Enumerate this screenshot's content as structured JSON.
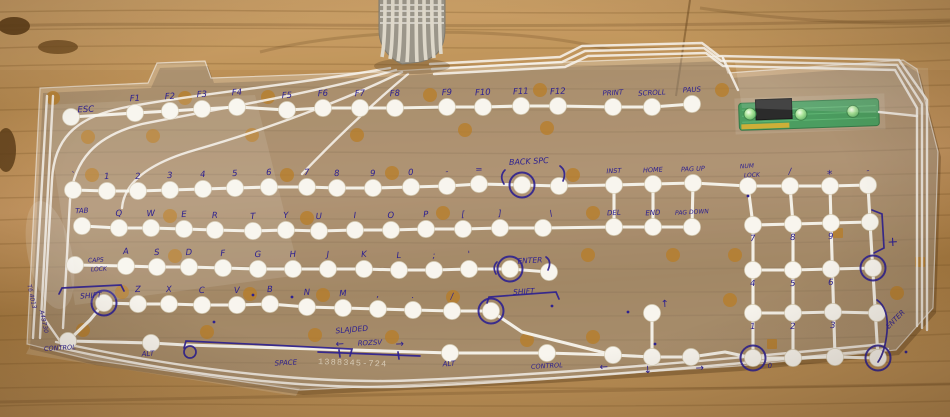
{
  "colors": {
    "wood": "#b88c52",
    "ink": "#2e2190",
    "trace": "#f8f5ee",
    "adhesive_dot": "#b97c22",
    "pcb_green": "#37924e",
    "led_green": "#6fd06f",
    "ribbon_gray": "#9b968a"
  },
  "pcb": {
    "led_count": 3
  },
  "membrane": {
    "part_number": "1388345-724",
    "keys": [
      {
        "t": "ESC",
        "x": 71,
        "y": 117,
        "lx": 86,
        "ly": 112
      },
      {
        "t": "F1",
        "x": 135,
        "y": 113
      },
      {
        "t": "F2",
        "x": 170,
        "y": 111
      },
      {
        "t": "F3",
        "x": 202,
        "y": 109
      },
      {
        "t": "F4",
        "x": 237,
        "y": 107
      },
      {
        "t": "F5",
        "x": 287,
        "y": 110
      },
      {
        "t": "F6",
        "x": 323,
        "y": 108
      },
      {
        "t": "F7",
        "x": 360,
        "y": 108
      },
      {
        "t": "F8",
        "x": 395,
        "y": 108
      },
      {
        "t": "F9",
        "x": 447,
        "y": 107
      },
      {
        "t": "F10",
        "x": 483,
        "y": 107
      },
      {
        "t": "F11",
        "x": 521,
        "y": 106
      },
      {
        "t": "F12",
        "x": 558,
        "y": 106
      },
      {
        "t": "PRINT",
        "x": 613,
        "y": 107,
        "s": 7
      },
      {
        "t": "SCROLL",
        "x": 652,
        "y": 107,
        "s": 7
      },
      {
        "t": "PAUS",
        "x": 692,
        "y": 104,
        "s": 7
      },
      {
        "t": "`",
        "x": 73,
        "y": 190
      },
      {
        "t": "1",
        "x": 107,
        "y": 191
      },
      {
        "t": "2",
        "x": 138,
        "y": 191
      },
      {
        "t": "3",
        "x": 170,
        "y": 190
      },
      {
        "t": "4",
        "x": 203,
        "y": 189
      },
      {
        "t": "5",
        "x": 235,
        "y": 188
      },
      {
        "t": "6",
        "x": 269,
        "y": 187
      },
      {
        "t": "7",
        "x": 307,
        "y": 187
      },
      {
        "t": "8",
        "x": 337,
        "y": 188
      },
      {
        "t": "9",
        "x": 373,
        "y": 188
      },
      {
        "t": "0",
        "x": 411,
        "y": 187
      },
      {
        "t": "-",
        "x": 447,
        "y": 186
      },
      {
        "t": "=",
        "x": 479,
        "y": 184
      },
      {
        "t": "",
        "x": 522,
        "y": 185,
        "r": 1
      },
      {
        "t": "",
        "x": 559,
        "y": 186
      },
      {
        "t": "INST",
        "x": 614,
        "y": 185,
        "s": 6.5
      },
      {
        "t": "HOME",
        "x": 653,
        "y": 184,
        "s": 6.5
      },
      {
        "t": "PAG UP",
        "x": 693,
        "y": 183,
        "s": 6.5
      },
      {
        "t": "",
        "x": 748,
        "y": 186
      },
      {
        "t": "/",
        "x": 790,
        "y": 186
      },
      {
        "t": "*",
        "x": 830,
        "y": 186,
        "s": 11,
        "ly": 178
      },
      {
        "t": "-",
        "x": 868,
        "y": 185
      },
      {
        "t": "TAB",
        "x": 82,
        "y": 226,
        "s": 7,
        "ly": 213
      },
      {
        "t": "Q",
        "x": 119,
        "y": 228
      },
      {
        "t": "W",
        "x": 151,
        "y": 228
      },
      {
        "t": "E",
        "x": 184,
        "y": 229
      },
      {
        "t": "R",
        "x": 215,
        "y": 230
      },
      {
        "t": "T",
        "x": 253,
        "y": 231
      },
      {
        "t": "Y",
        "x": 286,
        "y": 230
      },
      {
        "t": "U",
        "x": 319,
        "y": 231
      },
      {
        "t": "I",
        "x": 355,
        "y": 230
      },
      {
        "t": "O",
        "x": 391,
        "y": 230
      },
      {
        "t": "P",
        "x": 426,
        "y": 229
      },
      {
        "t": "[",
        "x": 463,
        "y": 229
      },
      {
        "t": "]",
        "x": 500,
        "y": 228
      },
      {
        "t": "\\",
        "x": 543,
        "y": 228,
        "lx": 551,
        "ly": 216
      },
      {
        "t": "DEL",
        "x": 614,
        "y": 227,
        "s": 7
      },
      {
        "t": "END",
        "x": 653,
        "y": 227,
        "s": 7
      },
      {
        "t": "PAG DOWN",
        "x": 692,
        "y": 227,
        "s": 6,
        "ly": 214
      },
      {
        "t": "7",
        "x": 753,
        "y": 225,
        "ly": 241
      },
      {
        "t": "8",
        "x": 793,
        "y": 224,
        "ly": 240
      },
      {
        "t": "9",
        "x": 831,
        "y": 223,
        "ly": 239
      },
      {
        "t": "",
        "x": 870,
        "y": 222
      },
      {
        "t": "",
        "x": 75,
        "y": 265
      },
      {
        "t": "A",
        "x": 126,
        "y": 266
      },
      {
        "t": "S",
        "x": 157,
        "y": 267
      },
      {
        "t": "D",
        "x": 189,
        "y": 267
      },
      {
        "t": "F",
        "x": 223,
        "y": 268
      },
      {
        "t": "G",
        "x": 258,
        "y": 269
      },
      {
        "t": "H",
        "x": 293,
        "y": 269
      },
      {
        "t": "J",
        "x": 328,
        "y": 269
      },
      {
        "t": "K",
        "x": 364,
        "y": 269
      },
      {
        "t": "L",
        "x": 399,
        "y": 270
      },
      {
        "t": ";",
        "x": 434,
        "y": 270
      },
      {
        "t": "'",
        "x": 469,
        "y": 269
      },
      {
        "t": "",
        "x": 510,
        "y": 269,
        "r": 1
      },
      {
        "t": "",
        "x": 549,
        "y": 272
      },
      {
        "t": "",
        "x": 104,
        "y": 303,
        "r": 1
      },
      {
        "t": "Z",
        "x": 138,
        "y": 304
      },
      {
        "t": "X",
        "x": 169,
        "y": 304
      },
      {
        "t": "C",
        "x": 202,
        "y": 305
      },
      {
        "t": "V",
        "x": 237,
        "y": 305
      },
      {
        "t": "B",
        "x": 270,
        "y": 304
      },
      {
        "t": "N",
        "x": 307,
        "y": 307
      },
      {
        "t": "M",
        "x": 343,
        "y": 308
      },
      {
        "t": ",",
        "x": 378,
        "y": 309
      },
      {
        "t": ".",
        "x": 413,
        "y": 310
      },
      {
        "t": "/",
        "x": 452,
        "y": 311
      },
      {
        "t": "",
        "x": 491,
        "y": 311,
        "r": 1
      },
      {
        "t": "",
        "x": 68,
        "y": 341
      },
      {
        "t": "",
        "x": 151,
        "y": 343
      },
      {
        "t": "",
        "x": 450,
        "y": 353
      },
      {
        "t": "",
        "x": 547,
        "y": 353
      },
      {
        "t": "←",
        "x": 613,
        "y": 355,
        "lx": 604,
        "ly": 370,
        "s": 10
      },
      {
        "t": "↓",
        "x": 652,
        "y": 357,
        "lx": 648,
        "ly": 373,
        "s": 10
      },
      {
        "t": "→",
        "x": 691,
        "y": 357,
        "lx": 700,
        "ly": 371,
        "s": 10
      },
      {
        "t": "↑",
        "x": 652,
        "y": 313,
        "lx": 665,
        "ly": 307,
        "s": 10
      },
      {
        "t": "4",
        "x": 753,
        "y": 270,
        "ly": 286
      },
      {
        "t": "5",
        "x": 793,
        "y": 270,
        "ly": 286
      },
      {
        "t": "6",
        "x": 831,
        "y": 269,
        "ly": 285
      },
      {
        "t": "",
        "x": 873,
        "y": 268,
        "r": 1
      },
      {
        "t": "1",
        "x": 753,
        "y": 313,
        "ly": 329
      },
      {
        "t": "2",
        "x": 793,
        "y": 313,
        "ly": 329
      },
      {
        "t": "3",
        "x": 833,
        "y": 312,
        "ly": 328
      },
      {
        "t": "",
        "x": 877,
        "y": 313
      },
      {
        "t": "0",
        "x": 753,
        "y": 358,
        "r": 1,
        "lx": 770,
        "ly": 368,
        "s": 7
      },
      {
        "t": "",
        "x": 793,
        "y": 358
      },
      {
        "t": "",
        "x": 835,
        "y": 357
      },
      {
        "t": "",
        "x": 878,
        "y": 358,
        "r": 1
      }
    ],
    "annotations": [
      {
        "t": "BACK SPC",
        "x": 529,
        "y": 164,
        "s": 8
      },
      {
        "t": "ENTER",
        "x": 530,
        "y": 263,
        "s": 7.5
      },
      {
        "t": "SHIFT",
        "x": 91,
        "y": 298,
        "s": 7.5
      },
      {
        "t": "SHIFT",
        "x": 524,
        "y": 294,
        "s": 7.5
      },
      {
        "t": "CAPS",
        "x": 96,
        "y": 262,
        "s": 6
      },
      {
        "t": "LOCK",
        "x": 99,
        "y": 271,
        "s": 6
      },
      {
        "t": "NUM",
        "x": 747,
        "y": 168,
        "s": 6
      },
      {
        "t": "LOCK",
        "x": 752,
        "y": 177,
        "s": 6
      },
      {
        "t": "CONTROL",
        "x": 60,
        "y": 350,
        "s": 6.5
      },
      {
        "t": "ALT",
        "x": 148,
        "y": 356,
        "s": 7
      },
      {
        "t": "SPACE",
        "x": 286,
        "y": 365,
        "s": 7
      },
      {
        "t": "ALT",
        "x": 449,
        "y": 366,
        "s": 7
      },
      {
        "t": "CONTROL",
        "x": 547,
        "y": 368,
        "s": 6.5
      },
      {
        "t": "SLAJDED",
        "x": 352,
        "y": 332,
        "s": 7.5,
        "rot": -5
      },
      {
        "t": "ROZSV",
        "x": 370,
        "y": 345,
        "s": 7
      },
      {
        "t": "←",
        "x": 340,
        "y": 347,
        "s": 10
      },
      {
        "t": "→",
        "x": 400,
        "y": 347,
        "s": 10
      },
      {
        "t": "+",
        "x": 893,
        "y": 246,
        "s": 13
      },
      {
        "t": "ENTER",
        "x": 897,
        "y": 321,
        "s": 7,
        "rot": -45
      },
      {
        "t": "T6 4013",
        "x": 30,
        "y": 297,
        "s": 6,
        "rot": 78
      },
      {
        "t": "A48730",
        "x": 42,
        "y": 322,
        "s": 6,
        "rot": 78
      }
    ],
    "adhesive_dots": [
      [
        53,
        98
      ],
      [
        88,
        137
      ],
      [
        153,
        136
      ],
      [
        185,
        98
      ],
      [
        252,
        135
      ],
      [
        268,
        97
      ],
      [
        287,
        175
      ],
      [
        430,
        95
      ],
      [
        540,
        90
      ],
      [
        357,
        135
      ],
      [
        465,
        130
      ],
      [
        547,
        128
      ],
      [
        92,
        175
      ],
      [
        170,
        216
      ],
      [
        307,
        218
      ],
      [
        175,
        256
      ],
      [
        250,
        294
      ],
      [
        323,
        295
      ],
      [
        122,
        292
      ],
      [
        392,
        173
      ],
      [
        443,
        213
      ],
      [
        573,
        175
      ],
      [
        593,
        213
      ],
      [
        453,
        297
      ],
      [
        588,
        255
      ],
      [
        83,
        330
      ],
      [
        207,
        332
      ],
      [
        315,
        335
      ],
      [
        392,
        337
      ],
      [
        527,
        340
      ],
      [
        593,
        337
      ],
      [
        730,
        300
      ],
      [
        673,
        255
      ],
      [
        735,
        255
      ],
      [
        897,
        293
      ],
      [
        722,
        90
      ],
      [
        838,
        233,
        1
      ],
      [
        772,
        344,
        1
      ],
      [
        920,
        262,
        1
      ]
    ]
  }
}
